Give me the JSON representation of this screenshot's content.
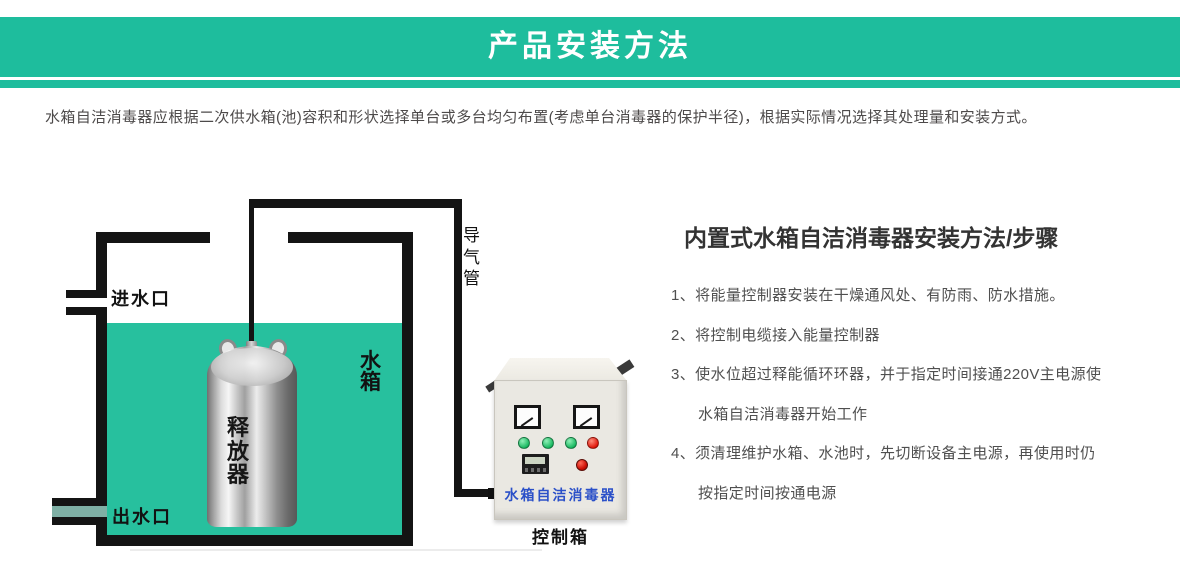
{
  "banner": {
    "title": "产品安装方法"
  },
  "colors": {
    "accent_green": "#1ebd9d",
    "water_green": "#27c09e",
    "intro_text_gray": "#4d4a4a",
    "heading_dark": "#333333",
    "control_brand_blue": "#2b50c8",
    "indicator_green": "#17b75f",
    "indicator_red": "#df1408"
  },
  "intro": {
    "text": "水箱自洁消毒器应根据二次供水箱(池)容积和形状选择单台或多台均匀布置(考虑单台消毒器的保护半径)，根据实际情况选择其处理量和安装方式。"
  },
  "diagram": {
    "inlet_label": "进水口",
    "outlet_label": "出水口",
    "tank_label": "水箱",
    "releaser_label": "释放器",
    "air_duct_label": "导气管",
    "control_box_caption": "控制箱",
    "control_box_brand": "水箱自洁消毒器"
  },
  "instructions": {
    "heading": "内置式水箱自洁消毒器安装方法/步骤",
    "lines": [
      {
        "text": "1、将能量控制器安装在干燥通风处、有防雨、防水措施。"
      },
      {
        "text": "2、将控制电缆接入能量控制器"
      },
      {
        "text": "3、使水位超过释能循环环器，并于指定时间接通220V主电源使"
      },
      {
        "text": "水箱自洁消毒器开始工作"
      },
      {
        "text": "4、须清理维护水箱、水池时，先切断设备主电源，再使用时仍"
      },
      {
        "text": "按指定时间按通电源"
      }
    ]
  }
}
